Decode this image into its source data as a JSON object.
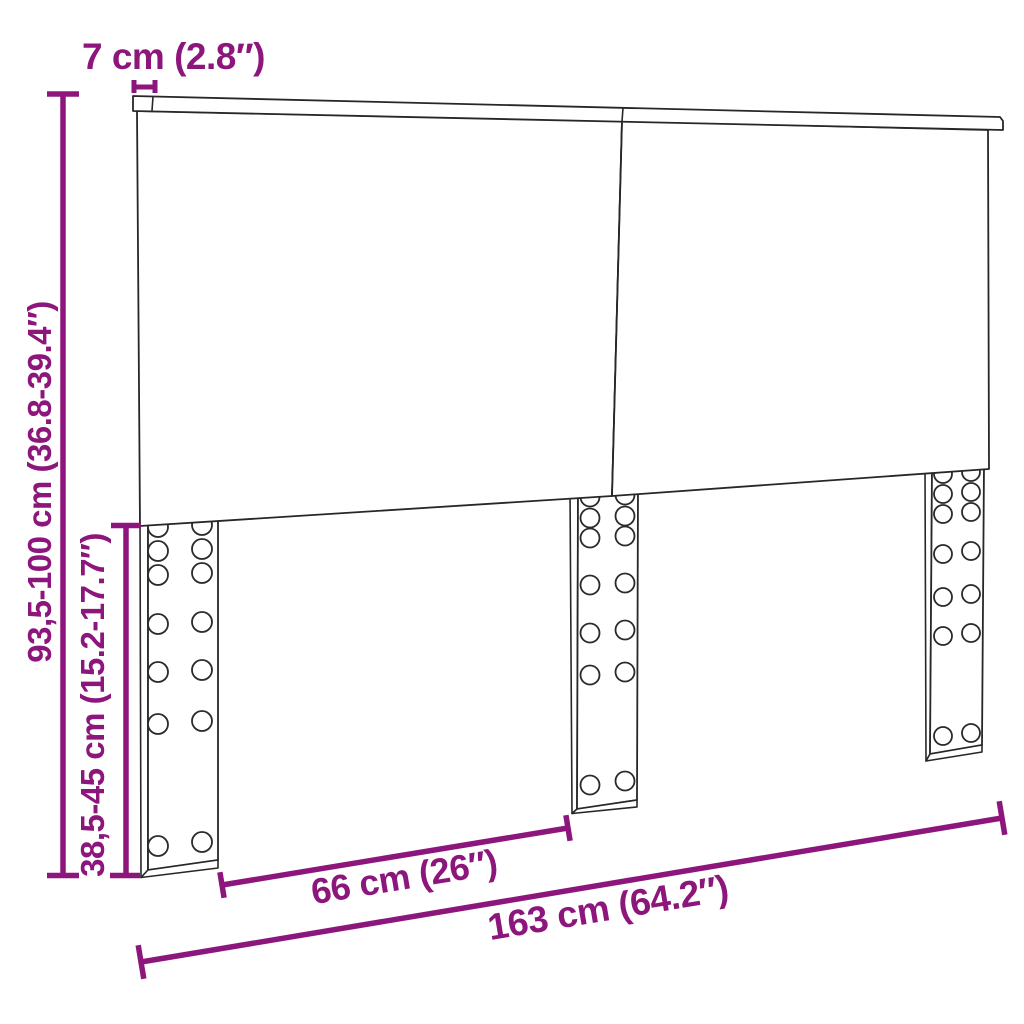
{
  "page": {
    "background_color": "#ffffff",
    "accent_color": "#8d167c",
    "outline_color": "#272727"
  },
  "diagram": {
    "subject": "headboard with adjustable legs",
    "labels": {
      "rail_thickness": "7 cm (2.8″)",
      "total_height": "93,5-100 cm (36.8-39.4″)",
      "leg_height": "38,5-45 cm (15.2-17.7″)",
      "leg_spacing_width": "66 cm (26″)",
      "total_width": "163 cm (64.2″)"
    }
  }
}
